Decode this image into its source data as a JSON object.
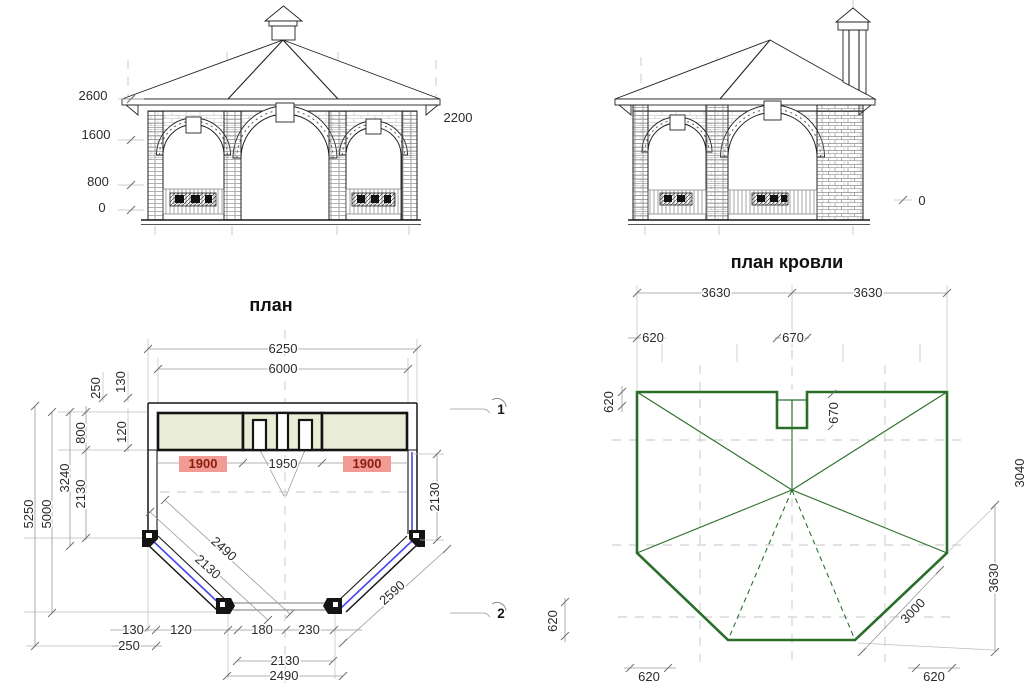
{
  "palette": {
    "line_black": "#1f1f1f",
    "dim_gray": "#9a9a9a",
    "roof_green": "#2a6e2a",
    "bench_fill": "#e9edd5",
    "highlight_bg": "#f29a94",
    "highlight_text": "#8a1d10",
    "rail_blue": "#4646ef"
  },
  "front_elevation": {
    "level_labels": [
      "2600",
      "1600",
      "800",
      "0"
    ],
    "right_label": "2200"
  },
  "side_elevation": {
    "ground_label": "0"
  },
  "floor_plan": {
    "title": "план",
    "overall_width": "6250",
    "inner_width": "6000",
    "left_col": {
      "d250": "250",
      "d130": "130",
      "d120": "120",
      "d800": "800",
      "d3240": "3240",
      "d2130": "2130",
      "d5250": "5250",
      "d5000": "5000"
    },
    "bay_dims": [
      {
        "value": "1900",
        "highlight": true
      },
      {
        "value": "1950",
        "highlight": false
      },
      {
        "value": "1900",
        "highlight": true
      }
    ],
    "right_dim": "2130",
    "diag_left_outer": "2490",
    "diag_left_inner": "2130",
    "diag_right": "2590",
    "axis_markers": [
      "1",
      "2"
    ],
    "bottom_row": {
      "d130": "130",
      "d250": "250",
      "d120": "120",
      "d180": "180",
      "d230": "230"
    },
    "bottom_width_inner": "2130",
    "bottom_width_outer": "2490"
  },
  "roof_plan": {
    "title": "план кровли",
    "top_spans": [
      "3630",
      "3630"
    ],
    "offset_left": "620",
    "chimney_width": "670",
    "edge_left_top": "620",
    "chimney_height": "670",
    "edge_left_bottom": "620",
    "right_span": "3630",
    "hip_length": "3000",
    "bottom_offsets": [
      "620",
      "620"
    ],
    "partial_right": "3040"
  }
}
